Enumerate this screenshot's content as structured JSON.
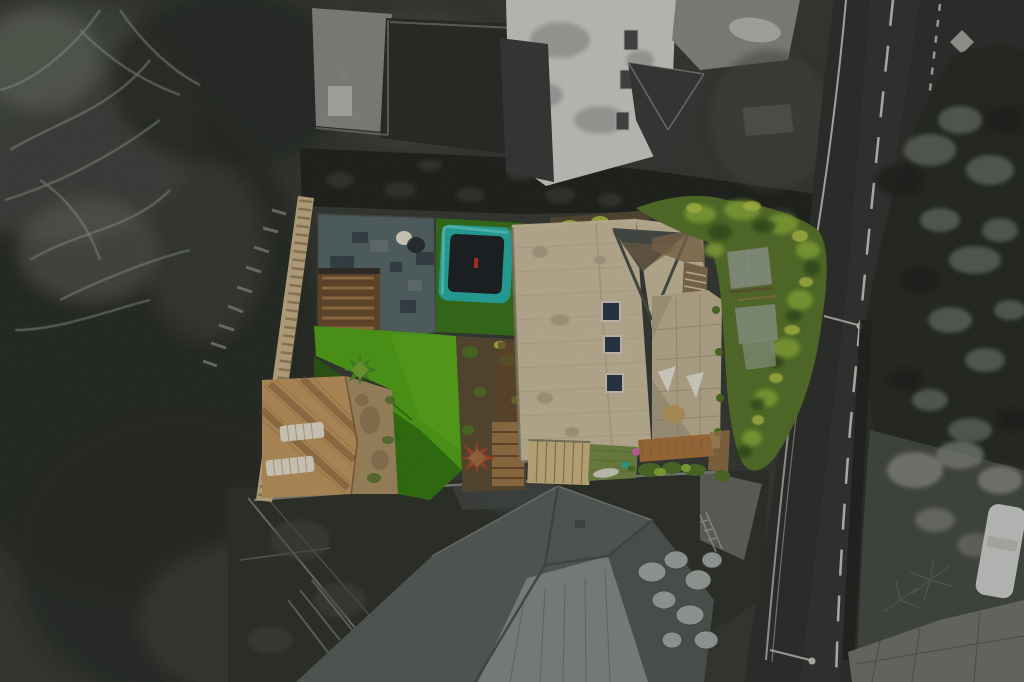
{
  "scene": {
    "type": "aerial-drone-photograph",
    "description": "Top-down drone photo of a residential plot. The featured property (house with beige stone roof, bright artificial lawn, teal trampoline, slate patio, timber deck with sun loungers, sheds and mature trees) is rendered in colour, while all surrounding land, neighbouring houses, woodland and the road on the right are desaturated grayscale.",
    "no_visible_text": true,
    "highlight_style": "selective-colour property mask over grayscale surroundings"
  },
  "objects": {
    "property_colour": [
      "slate paved terrace",
      "timber staircase",
      "teal trampoline with dark mat",
      "artificial bright-green lawn with diagonal shadow",
      "planted soil borders",
      "red cordyline plant",
      "green palm",
      "timber sun deck with two cream loungers",
      "sandy bank",
      "beige stone house roof with slate valley and three rooflights",
      "flagstone patio with white chairs and round table",
      "timber plank shed",
      "small olive lawn with pink ball",
      "green trees and two grey-green shed roofs along the road",
      "yellow-green roadside hedge",
      "pink flowering shrub"
    ],
    "surroundings_grayscale": [
      "bare winter tree branches",
      "dense scrub and woodland",
      "upper neighbour house with pale flat roof and dark pitched gable",
      "driveway with parked car",
      "asphalt road with centre dashes, edge lines, diamond marking and street lamps",
      "roadside tree canopy",
      "lower neighbour house with grey hipped roof",
      "boulder pile",
      "shrub garden with parked white car",
      "pale paved areas"
    ]
  },
  "palette": {
    "surround_base": "#3b3e38",
    "scrub_dark": "#2d302a",
    "scrub_mid": "#4b4f48",
    "scrub_light": "#6d7268",
    "branch_light": "#9aa098",
    "hedge_dark": "#252822",
    "neighbor_lawn": "#2f322b",
    "wall_line": "#8f9289",
    "flat_roof_white": "#d6d6d0",
    "dark_roof": "#3d403e",
    "driveway": "#8d908a",
    "car_gray": "#b9bcb6",
    "road": "#333532",
    "road_mark": "#d7d7d2",
    "tree_gray_dark": "#2b2f29",
    "tree_gray_light": "#6d7369",
    "shrub_light": "#8f948a",
    "paving_pale": "#74776e",
    "car_white": "#d2d5d1",
    "yard_dark": "#34362f",
    "b_roof": "#5e6361",
    "b_roof_light": "#8b918d",
    "b_roof_dark": "#494d4b",
    "rock_light": "#a7aca7",
    "fence_tan": "#cdb78e",
    "fence_dark": "#6b5836",
    "slate_patio": "#5d6c6e",
    "slate_dark": "#36434a",
    "slate_light": "#7b8a8a",
    "wood_stair": "#6e4f31",
    "wood_tread": "#a87e4e",
    "tramp_grass": "#3c7a1d",
    "tramp_teal": "#2cb5ac",
    "tramp_teal_light": "#67d8cf",
    "tramp_mat": "#212628",
    "tramp_red": "#c23527",
    "bed_soil": "#5f5138",
    "plant_yellow": "#aabd43",
    "plant_green": "#55772a",
    "lawn_bright": "#57aa1c",
    "lawn_sun": "#68bb24",
    "lawn_shadow": "#2f6d10",
    "deck_wood": "#c69c63",
    "deck_plank": "#a97f4c",
    "deck_shadow": "#7c5733",
    "lounger_white": "#eae4d2",
    "sand": "#ae9569",
    "dirt_brown": "#8a7352",
    "cordyline_red": "#b04a2e",
    "palm_green": "#4e8f28",
    "roof_beige": "#cfc2a3",
    "roof_beige_dark": "#b9ab8b",
    "roof_edge": "#8a8068",
    "roof_moss": "#a39a7f",
    "roof_slate": "#4e534f",
    "roof_valley": "#8a6f4d",
    "skylight_blue": "#2e3d4d",
    "skylight_frame": "#d9d3c3",
    "patio_stone": "#c6b998",
    "patio_line": "#a29476",
    "chair_white": "#ece9db",
    "table_tan": "#c3a368",
    "step_light": "#d8c9a8",
    "shed_tan": "#d3bd89",
    "shed_line": "#8a744c",
    "minilawn": "#7b8f4b",
    "ball_pink": "#cf6fb0",
    "board_white": "#dcd8ca",
    "deckband": "#b0773f",
    "tree_base": "#5d7a2e",
    "tree_light": "#8fb23c",
    "tree_lighter": "#bccf4d",
    "tree_shadow": "#35511b",
    "shedroof_green": "#93a188",
    "flower_pink": "#d773ae"
  }
}
